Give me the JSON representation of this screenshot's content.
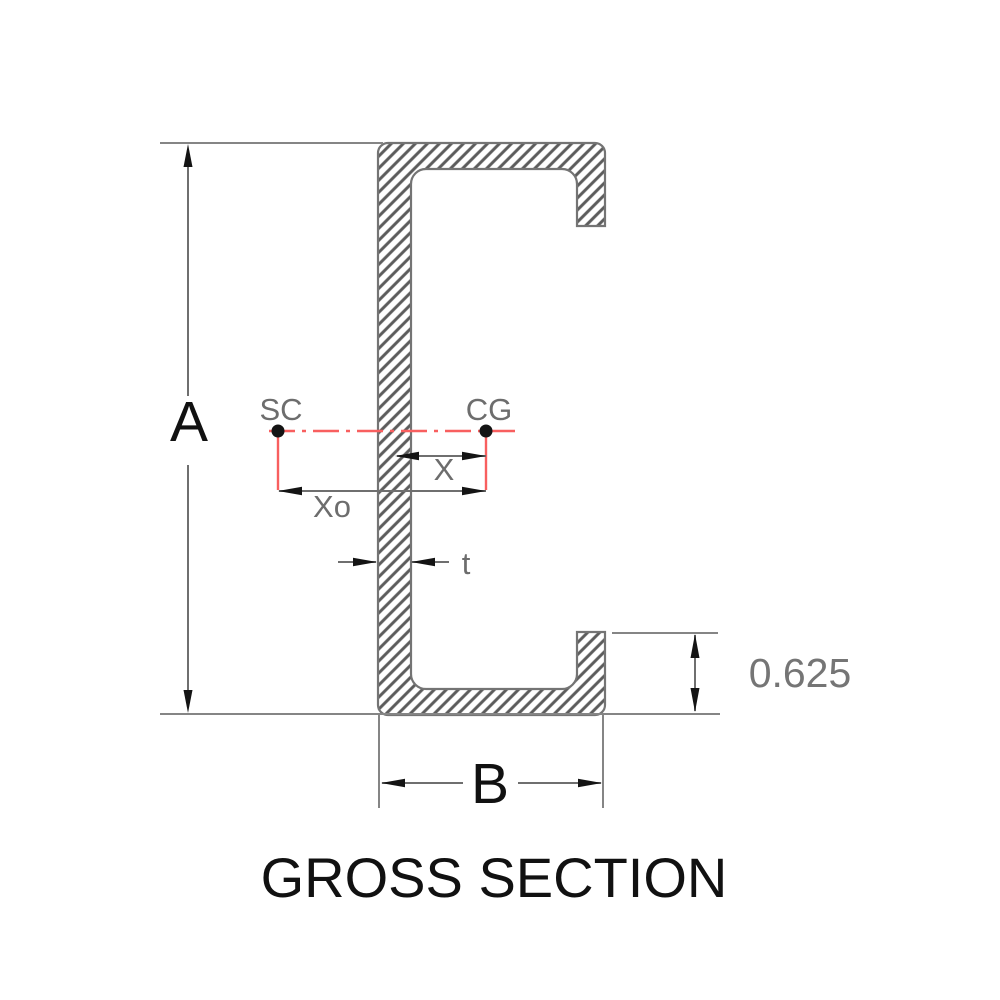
{
  "title": "GROSS SECTION",
  "labels": {
    "depth": "A",
    "flange_width": "B",
    "centroid_offset": "X",
    "shear_center_offset": "Xo",
    "thickness": "t",
    "shear_center": "SC",
    "centroid": "CG",
    "lip_length": "0.625"
  },
  "colors": {
    "centerline_red": "#f85f5f",
    "hatch_gray": "#5c5c5c",
    "outline_gray": "#747474",
    "line_gray": "#7a7a7a",
    "ink_black": "#141414",
    "text_gray": "#6d6d6d"
  }
}
